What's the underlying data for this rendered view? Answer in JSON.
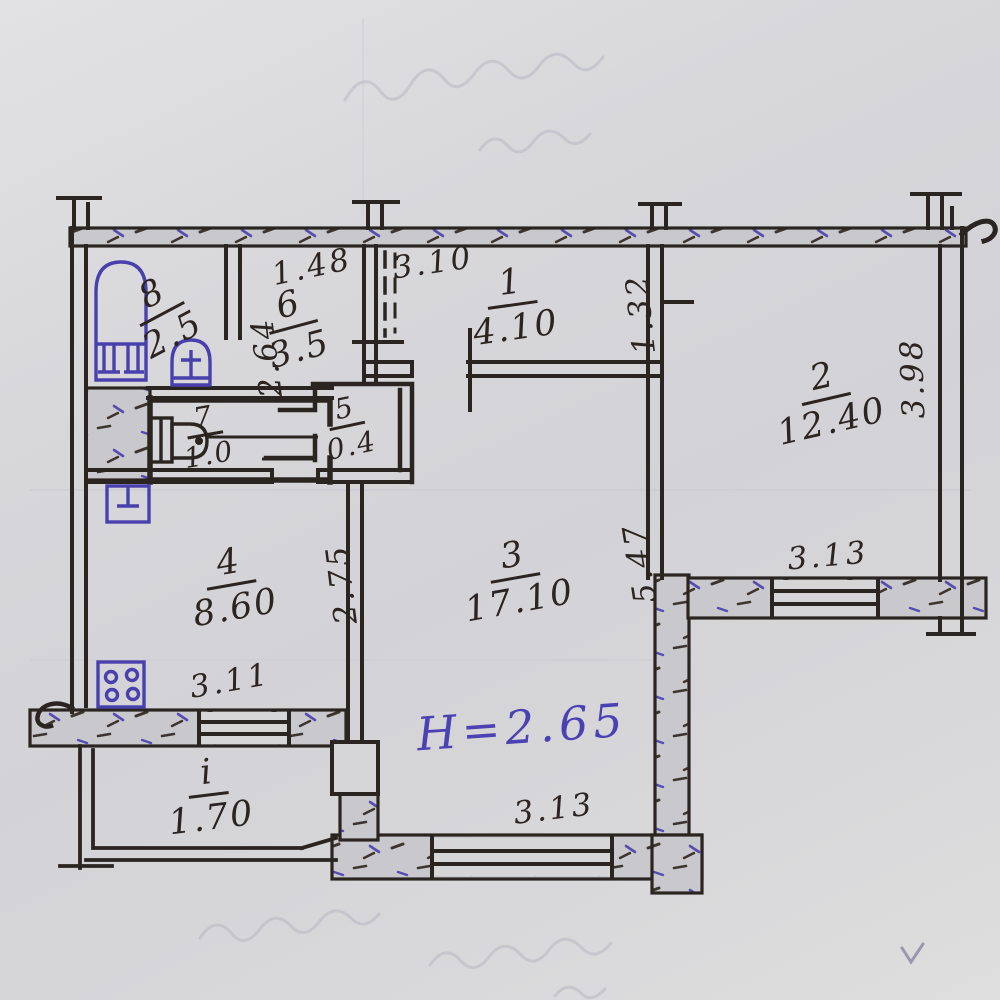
{
  "drawing_type": "hand-drawn apartment floor plan (BTI sketch)",
  "rooms": {
    "r1": {
      "number": "1",
      "area": "4.10"
    },
    "r2": {
      "number": "2",
      "area": "12.40"
    },
    "r3": {
      "number": "3",
      "area": "17.10"
    },
    "r4": {
      "number": "4",
      "area": "8.60"
    },
    "r5": {
      "number": "5",
      "area": "0.4"
    },
    "r6": {
      "number": "6",
      "area": "3.5"
    },
    "r7": {
      "number": "7",
      "area": "1.0"
    },
    "r8": {
      "number": "8",
      "area": "2.5"
    },
    "balcony": {
      "number": "i",
      "area": "1.70"
    }
  },
  "dimensions": {
    "entry_width": "1.48",
    "hall_width": "3.10",
    "hall_right": "1.32",
    "room2_side": "3.98",
    "room6_side": "2.64",
    "kitchen_side": "2.75",
    "room3_side": "5.47",
    "room2_window": "3.13",
    "room3_window": "3.13",
    "kitchen_window": "3.11"
  },
  "height_note": "H=2.65",
  "fixtures": [
    "bathtub",
    "washbasin",
    "toilet",
    "kitchen-sink",
    "stove-4-burner"
  ],
  "colors": {
    "paper": "#d6d6d9",
    "ink": "#2b2521",
    "blue_ink": "#4a40ad",
    "wall_fill": "#cacace",
    "pencil_bleed": "#b6b6c0"
  }
}
